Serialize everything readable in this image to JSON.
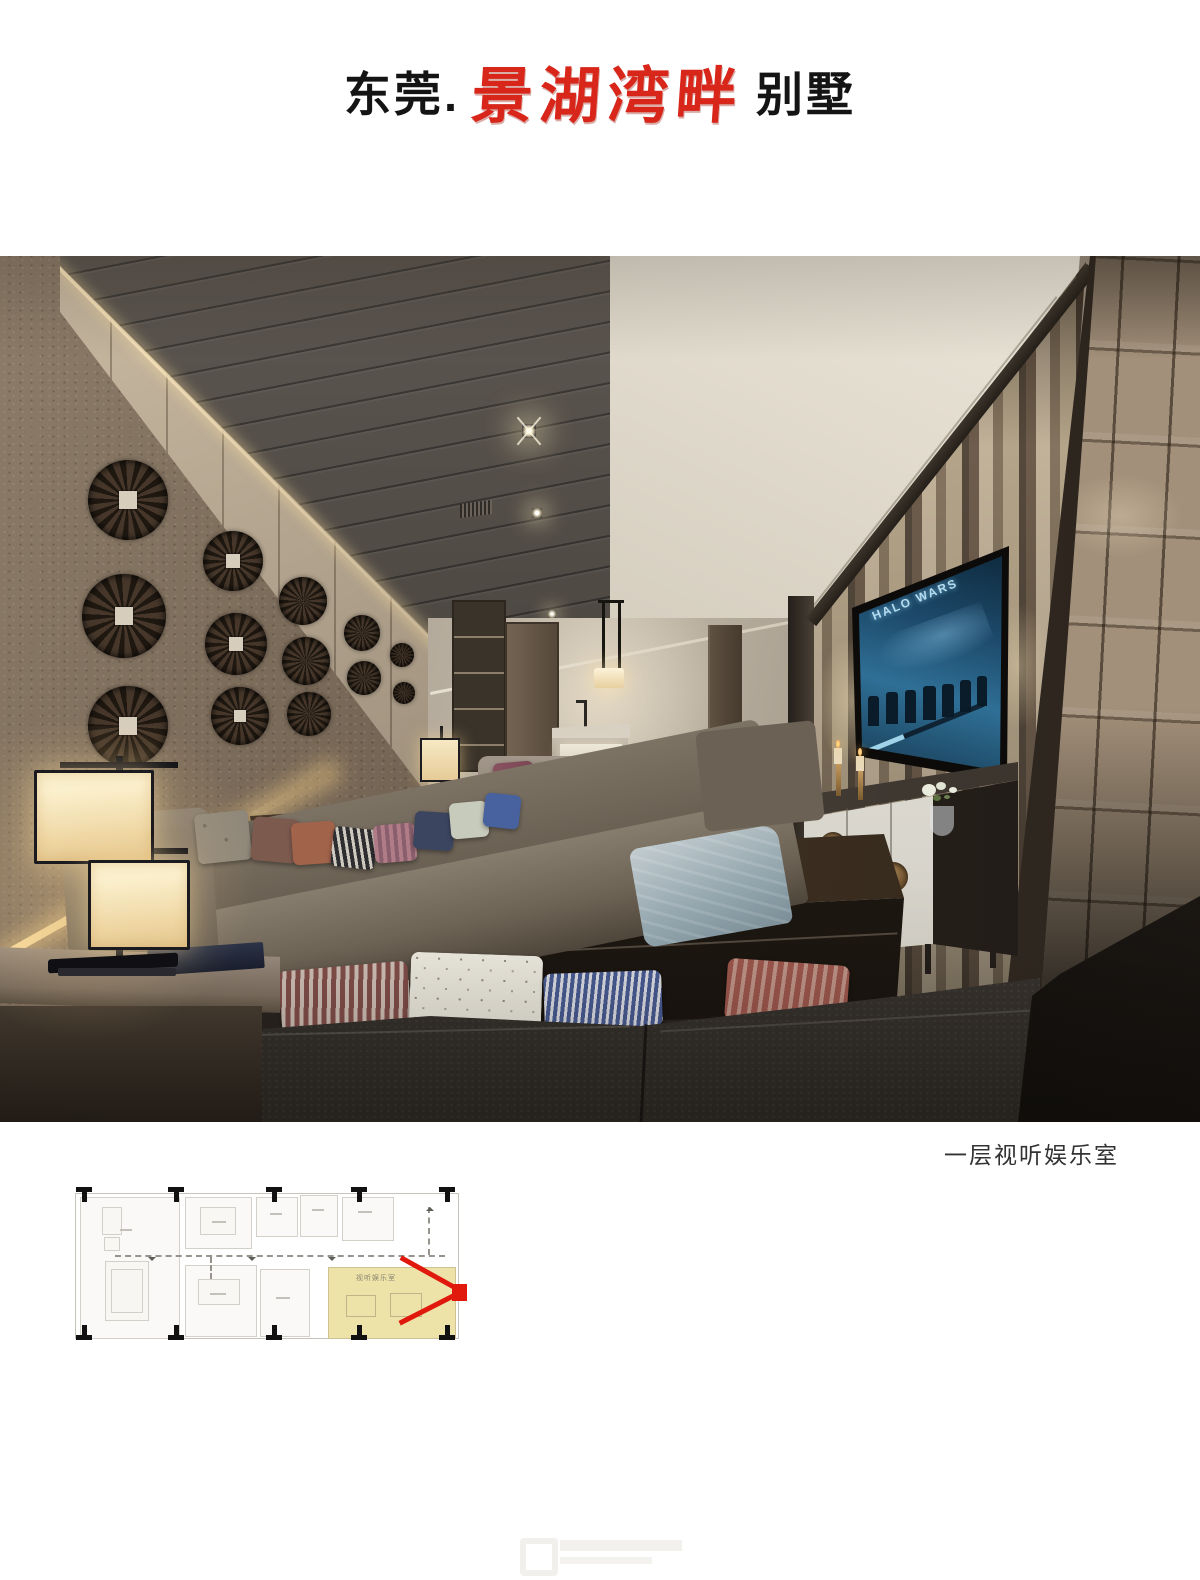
{
  "title": {
    "prefix": "东莞.",
    "brand": "景湖湾畔",
    "suffix": "别墅"
  },
  "photo": {
    "caption": "一层视听娱乐室",
    "tv_title": "HALO WARS"
  },
  "floor_plan": {
    "room_label": "视听娱乐室"
  },
  "colors": {
    "brand_red": "#d8261a",
    "plan_marker_red": "#e0190c",
    "plan_highlight_yellow": "#e9dc94",
    "tv_screen_blue": "#1d4a6b"
  }
}
